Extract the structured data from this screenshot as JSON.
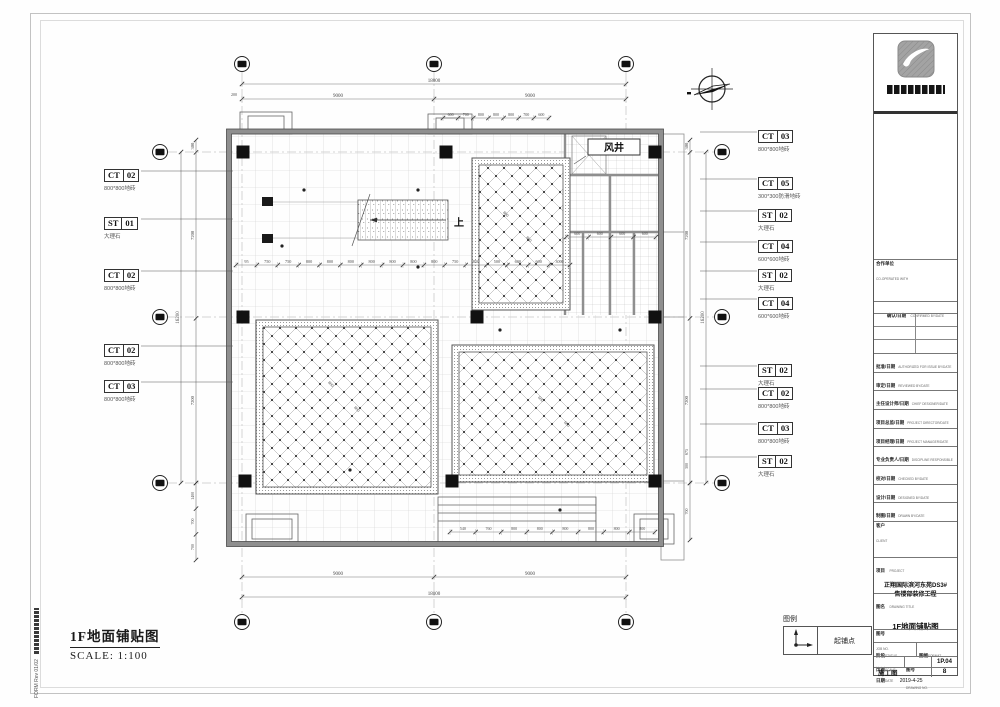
{
  "sheet": {
    "title": "1F地面铺贴图",
    "scale": "SCALE: 1:100",
    "margin_note": "FORM Rev 01/02",
    "sheet_no": "8"
  },
  "legend": {
    "heading": "图例",
    "items": [
      {
        "icon": "tile-start-point-icon",
        "label": "起铺点"
      }
    ]
  },
  "plan": {
    "air_shaft_label": "风井",
    "stair_up_label": "上",
    "dims": {
      "top_overall": "18000",
      "top_segments": [
        "9000",
        "9000"
      ],
      "top_edge": "200",
      "bottom_overall": "18000",
      "bottom_segments": [
        "9000",
        "9000"
      ],
      "left_overall": "16200",
      "left_segments": [
        "300",
        "7200",
        "7200"
      ],
      "left_bottom_segments": [
        "1400",
        "700",
        "700"
      ],
      "right_overall": "16200",
      "right_segments": [
        "300",
        "7200",
        "7200"
      ],
      "right_bottom_segments": [
        "700"
      ],
      "mid_chain": [
        "95",
        "750",
        "750",
        "800",
        "800",
        "800",
        "800",
        "800",
        "800",
        "800",
        "750",
        "850",
        "500",
        "600",
        "600",
        "3000"
      ],
      "top_small_chain": [
        "600",
        "700",
        "800",
        "800",
        "800",
        "700",
        "600"
      ],
      "bottom_small_chain": [
        "540",
        "760",
        "800",
        "800",
        "800",
        "800",
        "800",
        "800"
      ],
      "toilet_chain": [
        "600",
        "600",
        "600",
        "600"
      ],
      "tile_labels_room_a": [
        "800",
        "800"
      ],
      "tile_labels_room_b": [
        "800",
        "800"
      ],
      "tile_labels_room_c": [
        "600",
        "600"
      ],
      "misc": [
        "675",
        "300"
      ]
    }
  },
  "finish_labels": {
    "left": [
      {
        "code": "CT 02",
        "desc": "800*800地砖"
      },
      {
        "code": "ST 01",
        "desc": "大理石"
      },
      {
        "code": "CT 02",
        "desc": "800*800地砖"
      },
      {
        "code": "CT 02",
        "desc": "800*800地砖"
      },
      {
        "code": "CT 03",
        "desc": "800*800地砖"
      }
    ],
    "right": [
      {
        "code": "CT 03",
        "desc": "800*800地砖"
      },
      {
        "code": "CT 05",
        "desc": "300*300防滑地砖"
      },
      {
        "code": "ST 02",
        "desc": "大理石"
      },
      {
        "code": "CT 04",
        "desc": "600*600地砖"
      },
      {
        "code": "ST 02",
        "desc": "大理石"
      },
      {
        "code": "CT 04",
        "desc": "600*600地砖"
      },
      {
        "code": "ST 02",
        "desc": "大理石"
      },
      {
        "code": "CT 02",
        "desc": "800*800地砖"
      },
      {
        "code": "CT 03",
        "desc": "800*800地砖"
      },
      {
        "code": "ST 02",
        "desc": "大理石"
      }
    ]
  },
  "title_block": {
    "coop": {
      "cn": "合作单位",
      "en": "CO-OPERATED WITH"
    },
    "confirm": {
      "cn": "确认/日期",
      "en": "CONFIRMED BY/DATE"
    },
    "rows": [
      {
        "cn": "批准/日期",
        "en": "AUTHORIZED FOR ISSUE BY/DATE"
      },
      {
        "cn": "审定/日期",
        "en": "REVIEWED BY/DATE"
      },
      {
        "cn": "主任设计师/日期",
        "en": "CHIEF DESIGNER/DATE"
      },
      {
        "cn": "项目总监/日期",
        "en": "PROJECT DIRECTOR/DATE"
      },
      {
        "cn": "项目经理/日期",
        "en": "PROJECT MANAGER/DATE"
      },
      {
        "cn": "专业负责人/日期",
        "en": "DISCIPLINE RESPONSIBLE BY"
      },
      {
        "cn": "校对/日期",
        "en": "CHECKED BY/DATE"
      },
      {
        "cn": "设计/日期",
        "en": "DESIGNED BY/DATE"
      },
      {
        "cn": "制图/日期",
        "en": "DRAWN BY/DATE"
      }
    ],
    "client": {
      "cn": "客户",
      "en": "CLIENT"
    },
    "project": {
      "cn": "项目",
      "en": "PROJECT",
      "value_line1": "正翔国际滨河东苑DS3#",
      "value_line2": "售楼部装修工程"
    },
    "drawing_title": {
      "cn": "图名",
      "en": "DRAWING TITLE",
      "value": "1F地面铺贴图"
    },
    "job_no": {
      "cn": "图号",
      "en": "JOB NO."
    },
    "status": {
      "cn": "阶段",
      "en": "STATUS",
      "value": "施工图"
    },
    "format": {
      "cn": "图幅",
      "en": "FORMAT"
    },
    "scale": {
      "cn": "比例",
      "en": "SCALE"
    },
    "drawing_no": {
      "cn": "图号",
      "en": "DRAWING NO.",
      "value": "1P.04"
    },
    "date": {
      "cn": "日期",
      "en": "DATE",
      "value": "2019-4-25"
    }
  }
}
